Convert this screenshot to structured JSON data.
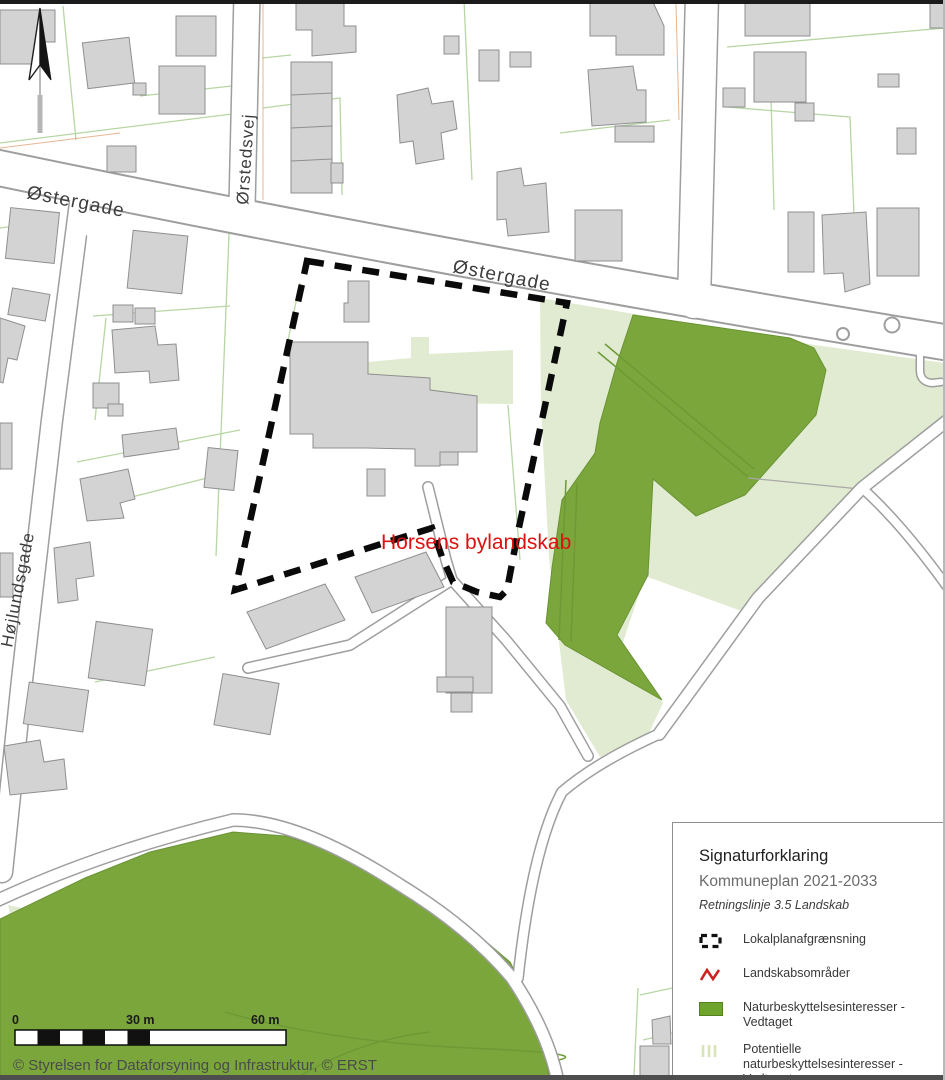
{
  "map": {
    "streets": {
      "ostergade_west": "Østergade",
      "ostergade_east": "Østergade",
      "orstedsvej": "Ørstedsvej",
      "hojlundsgade": "Højlundsgade"
    },
    "site_label": "Horsens bylandskab",
    "scalebar": {
      "zero": "0",
      "mid": "30 m",
      "end": "60 m"
    },
    "attribution": "© Styrelsen for Dataforsyning og Infrastruktur, © ERST",
    "colors": {
      "nature_green": "#7aa63c",
      "potential_green": "#e1ebd1",
      "building_fill": "#d3d3d3",
      "building_stroke": "#8f8f8f",
      "road_casing": "#9e9e9e",
      "parcel_line": "#b7d6a4",
      "boundary_black": "#0a0a0a",
      "label_red": "#dd1111",
      "legend_green": "#6ea32d",
      "legend_hatch": "#d9e3b8",
      "legend_red": "#cc2222"
    }
  },
  "legend": {
    "title": "Signaturforklaring",
    "subtitle": "Kommuneplan 2021-2033",
    "guideline": "Retningslinje 3.5 Landskab",
    "items": [
      {
        "symbol": "dashed-boundary-symbol",
        "lines": [
          "Lokalplanafgrænsning"
        ]
      },
      {
        "symbol": "red-zigzag-symbol",
        "lines": [
          "Landskabsområder"
        ]
      },
      {
        "symbol": "green-area-symbol",
        "lines": [
          "Naturbeskyttelsesinteresser -",
          "Vedtaget"
        ]
      },
      {
        "symbol": "hatch-area-symbol",
        "lines": [
          "Potentielle",
          "naturbeskyttelsesinteresser -",
          "Vedtaget"
        ]
      }
    ]
  }
}
